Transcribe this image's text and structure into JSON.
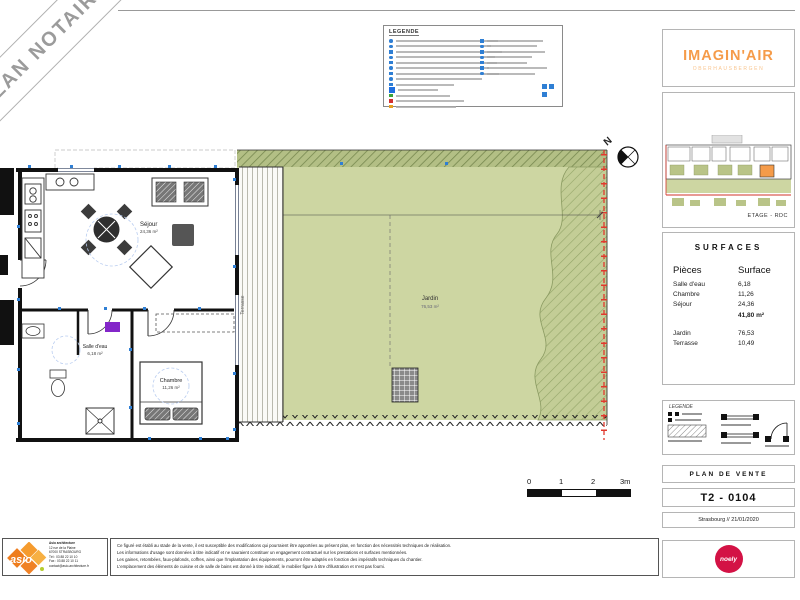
{
  "banner": {
    "text": "PLAN NOTAIRE"
  },
  "legend_top": {
    "title": "LEGENDE",
    "left_rows": [
      {
        "c": "#2f7fd4",
        "w": 102,
        "s": "dot"
      },
      {
        "c": "#2f7fd4",
        "w": 95,
        "s": "dot"
      },
      {
        "c": "#2f7fd4",
        "w": 106,
        "s": "sq"
      },
      {
        "c": "#2f7fd4",
        "w": 99,
        "s": "dot"
      },
      {
        "c": "#2f7fd4",
        "w": 101,
        "s": "sq"
      },
      {
        "c": "#2f7fd4",
        "w": 93,
        "s": "dot"
      },
      {
        "c": "#2f7fd4",
        "w": 103,
        "s": "sq"
      },
      {
        "c": "#2f7fd4",
        "w": 86,
        "s": "dot"
      },
      {
        "c": "#2f7fd4",
        "w": 58,
        "s": "sq"
      },
      {
        "c": "#1f6fe0",
        "w": 40,
        "s": "big"
      },
      {
        "c": "#3aa33a",
        "w": 54,
        "s": "sq"
      },
      {
        "c": "#d23030",
        "w": 68,
        "s": "sq"
      },
      {
        "c": "#e8a020",
        "w": 60,
        "s": "sq"
      }
    ],
    "right_rows": [
      {
        "c": "#2f7fd4",
        "w": 56,
        "s": "sq"
      },
      {
        "c": "#2f7fd4",
        "w": 50,
        "s": "dot"
      },
      {
        "c": "#2f7fd4",
        "w": 58,
        "s": "sq"
      },
      {
        "c": "#2f7fd4",
        "w": 45,
        "s": "dot"
      },
      {
        "c": "#2f7fd4",
        "w": 40,
        "s": "sq"
      },
      {
        "c": "#2f7fd4",
        "w": 60,
        "s": "sq"
      },
      {
        "c": "#2f7fd4",
        "w": 48,
        "s": "dot"
      }
    ]
  },
  "plan": {
    "north_label": "N",
    "rooms": {
      "sejour": {
        "name": "Séjour",
        "area": "24,36 m²"
      },
      "chambre": {
        "name": "Chambre",
        "area": "11,26 m²"
      },
      "salle_eau": {
        "name": "Salle d'eau",
        "area": "6,18 m²"
      },
      "jardin": {
        "name": "Jardin",
        "area": "76,53 m²"
      },
      "terrasse": {
        "name": "Terrasse"
      }
    }
  },
  "scalebar": {
    "labels": [
      "0",
      "1",
      "2",
      "3m"
    ]
  },
  "sidebar": {
    "brand": {
      "title": "IMAGIN'AIR",
      "subtitle": "OBERHAUSBERGEN"
    },
    "miniplan_caption": "ETAGE - RDC",
    "surfaces": {
      "title": "SURFACES",
      "columns": {
        "piece": "Pièces",
        "surface": "Surface"
      },
      "rows": [
        {
          "label": "Salle d'eau",
          "value": "6,18"
        },
        {
          "label": "Chambre",
          "value": "11,26"
        },
        {
          "label": "Séjour",
          "value": "24,36"
        }
      ],
      "total": "41,80 m²",
      "outdoor": [
        {
          "label": "Jardin",
          "value": "76,53"
        },
        {
          "label": "Terrasse",
          "value": "10,49"
        }
      ]
    },
    "legend_box_title": "LEGENDE",
    "plan_type": "PLAN DE VENTE",
    "lot_number": "T2 - 0104",
    "city_date": "Strasbourg // 21/01/2020",
    "publisher": {
      "name": "noely"
    }
  },
  "footer": {
    "asio_name": "asio",
    "asio_lines": [
      "Asio architecture",
      "12 rue de la Plaine",
      "67000 STRASBOURG",
      "Tél : 03 88 22 10 10",
      "Fax : 03 88 22 10 11",
      "contact@asio-architecture.fr"
    ],
    "disclaimer_lines": [
      "Ce figuré est établi au stade de la vente, il est susceptible des modifications qui pourraient être apportées au présent plan, en fonction des nécessités techniques de réalisation.",
      "Les informations d'usage sont données à titre indicatif et ne sauraient constituer un engagement contractuel sur les prestations et surfaces mentionnées.",
      "Les gaines, retombées, faux-plafonds, coffres, ainsi que l'implantation des équipements, pourront être adaptés en fonction des impératifs techniques du chantier.",
      "L'emplacement des éléments de cuisine et de salle de bains est donné à titre indicatif, le mobilier figure à titre d'illustration et n'est pas fourni."
    ]
  },
  "colors": {
    "brand_orange": "#f59b49",
    "noely_red": "#d31245",
    "asio_orange": "#f08226",
    "garden_green": "#cdd6a2",
    "boundary_red": "#e0392e",
    "symbol_blue": "#2f7fd4"
  }
}
